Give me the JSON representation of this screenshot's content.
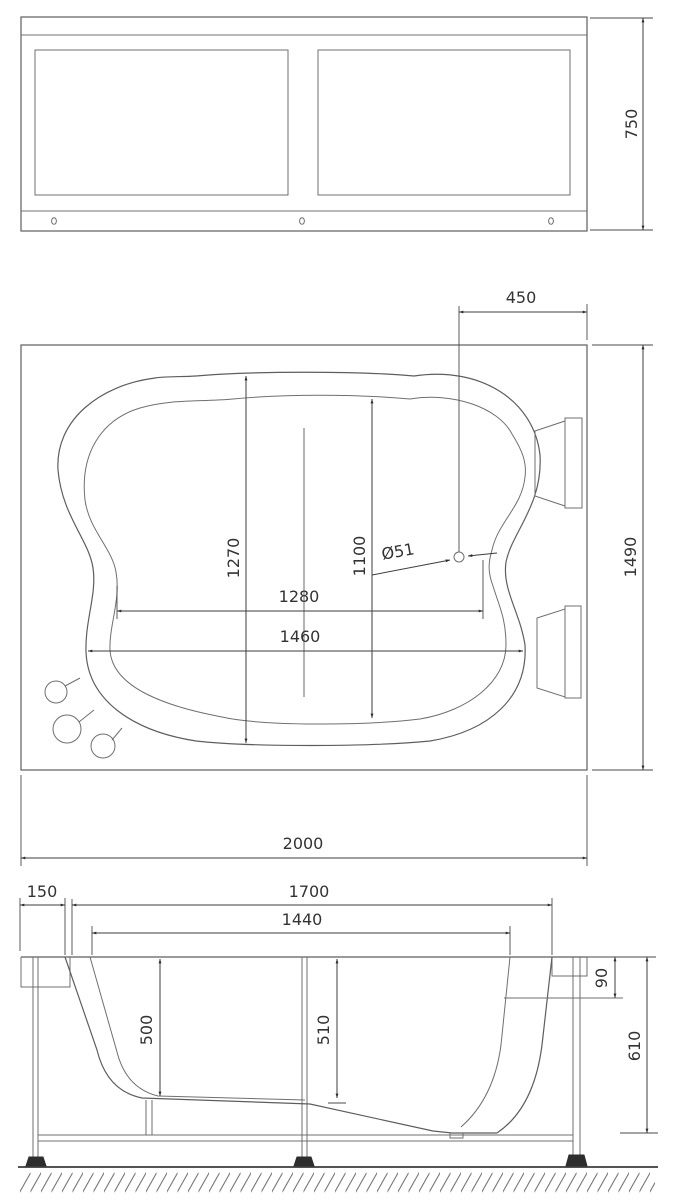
{
  "drawing": {
    "type": "bathtub technical drawing, three orthographic views",
    "front_view": {
      "height": "750"
    },
    "plan_view": {
      "offset_drain_from_edge": "450",
      "overall_width": "1490",
      "overall_length": "2000",
      "outer_basin_width": "1270",
      "inner_basin_width": "1100",
      "drain_diameter": "Ø51",
      "inner_basin_length": "1280",
      "outer_basin_length": "1460"
    },
    "side_view": {
      "rim_overhang": "150",
      "rim_to_wall_length": "1700",
      "inner_top_length": "1440",
      "overflow_depth": "90",
      "seat_depth_left": "500",
      "seat_depth_right": "510",
      "total_depth": "610"
    }
  }
}
